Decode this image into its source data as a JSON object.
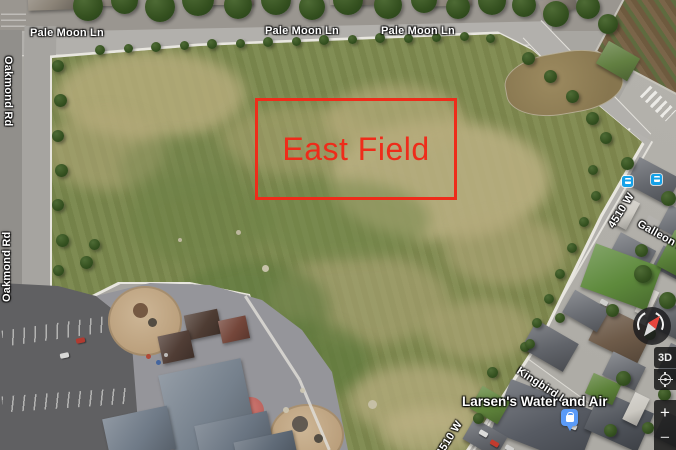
{
  "road_labels": {
    "pale_moon_1": "Pale Moon Ln",
    "pale_moon_2": "Pale Moon Ln",
    "pale_moon_3": "Pale Moon Ln",
    "oakmond_upper": "Oakmond Rd",
    "oakmond_lower": "Oakmond Rd",
    "w4510_upper": "4510 W",
    "w4510_lower": "4510 W",
    "galleon": "Galleon Ln",
    "kingbird": "Kingbird Ln"
  },
  "poi": {
    "larsen_label": "Larsen's Water and Air"
  },
  "annotation": {
    "label": "East Field",
    "color": "#ee2c1a"
  },
  "controls": {
    "tilt_label": "3D",
    "zoom_in_label": "+",
    "zoom_out_label": "−"
  },
  "icons": {
    "transit_stop_color": "#15a1e8",
    "store_pin_color": "#5b9bf8"
  }
}
